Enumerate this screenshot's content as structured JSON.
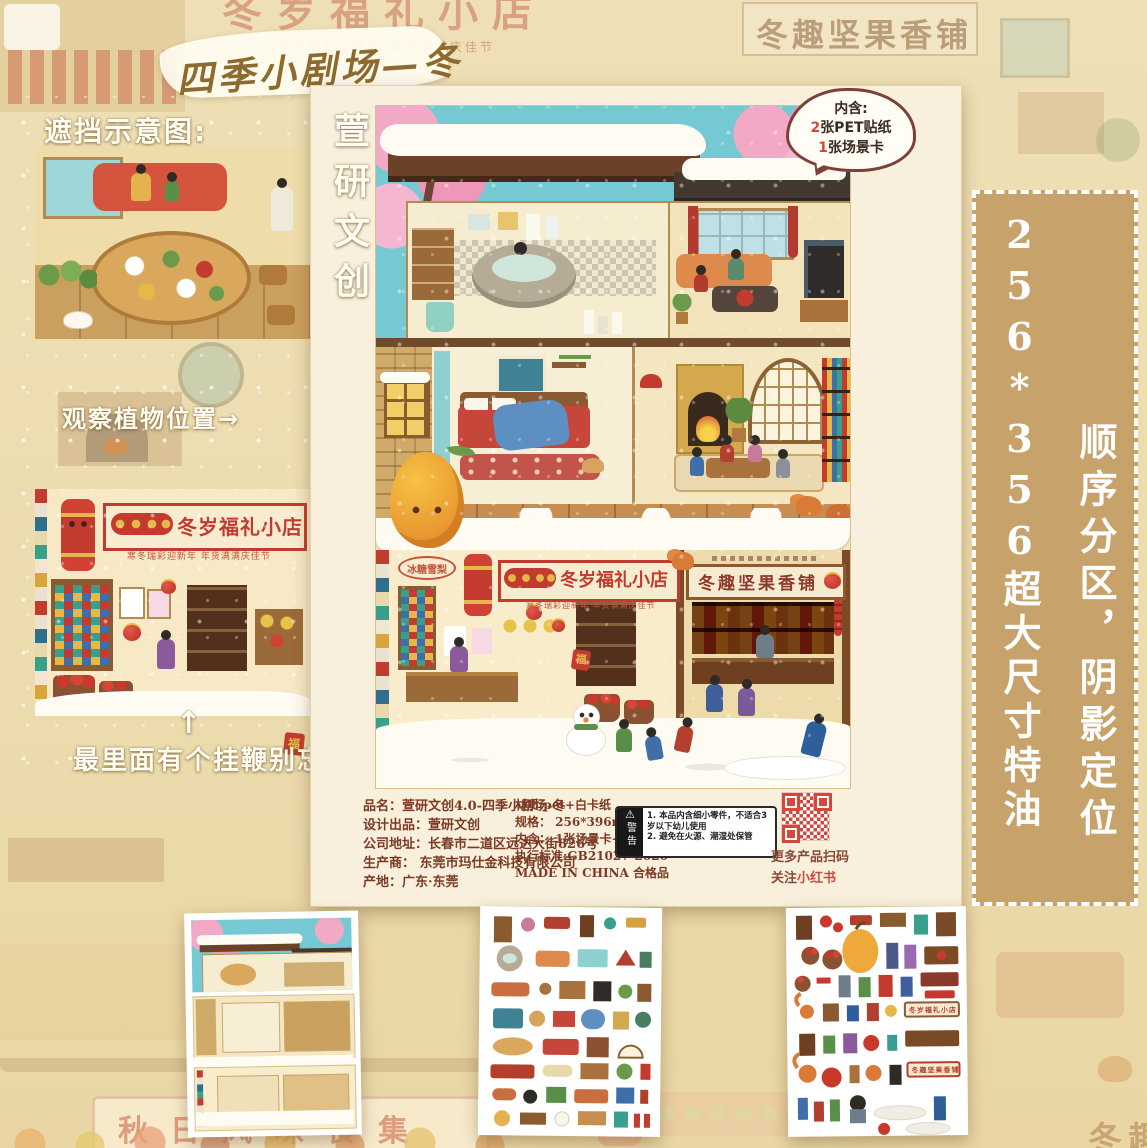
{
  "title": "四季小剧场—冬",
  "brand": "萱研文创",
  "left": {
    "occlusion": "遮挡示意图:",
    "plants": "观察植物位置→",
    "arrow": "↑",
    "whip": "最里面有个挂鞭别忘啦"
  },
  "bubble": {
    "heading": "内含:",
    "line1_num": "2",
    "line1_text": "张PET贴纸",
    "line2_num": "1",
    "line2_text": "张场景卡"
  },
  "poster": {
    "left_shop_sign": "冬岁福礼小店",
    "left_shop_tagline": "寒冬瑞彩迎新年 年货满满庆佳节",
    "right_shop_sign": "冬趣坚果香铺",
    "small_sign": "冰糖雪梨",
    "fu": "福"
  },
  "info": {
    "left": [
      "品名：萱研文创4.0-四季小剧场-冬",
      "设计出品：萱研文创",
      "公司地址：长春市二道区远达大街826号",
      "生产商：  东莞市玛仕金科技有限公司",
      "产地：广东·东莞"
    ],
    "right": [
      "材质:pet+白卡纸",
      "规格： 256*396mm",
      "内含： 1张场景卡+2张pet",
      "执行标准:GB21027-2020",
      "MADE IN CHINA 合格品"
    ]
  },
  "warning": {
    "label": "警告",
    "line1": "1. 本品内含细小零件，不适合3岁以下幼儿使用",
    "line2": "2. 避免在火源、潮湿处保管"
  },
  "qr": {
    "caption": "更多产品扫码",
    "follow_prefix": "关注",
    "follow_brand": "小红书"
  },
  "right_panel": {
    "size_text": "256*356超大尺寸特油",
    "feature_text": "顺序分区，阴影定位"
  },
  "bg": {
    "sign_autumn": "秋日风味食集"
  },
  "colors": {
    "accent_red": "#c23b2e",
    "panel_tan": "#c7a36b",
    "paper_cream": "#f8f0dc",
    "sky_blue": "#74c9d3",
    "blossom_pink": "#f2a9c5",
    "xiaohongshu_red": "#d5473d"
  }
}
